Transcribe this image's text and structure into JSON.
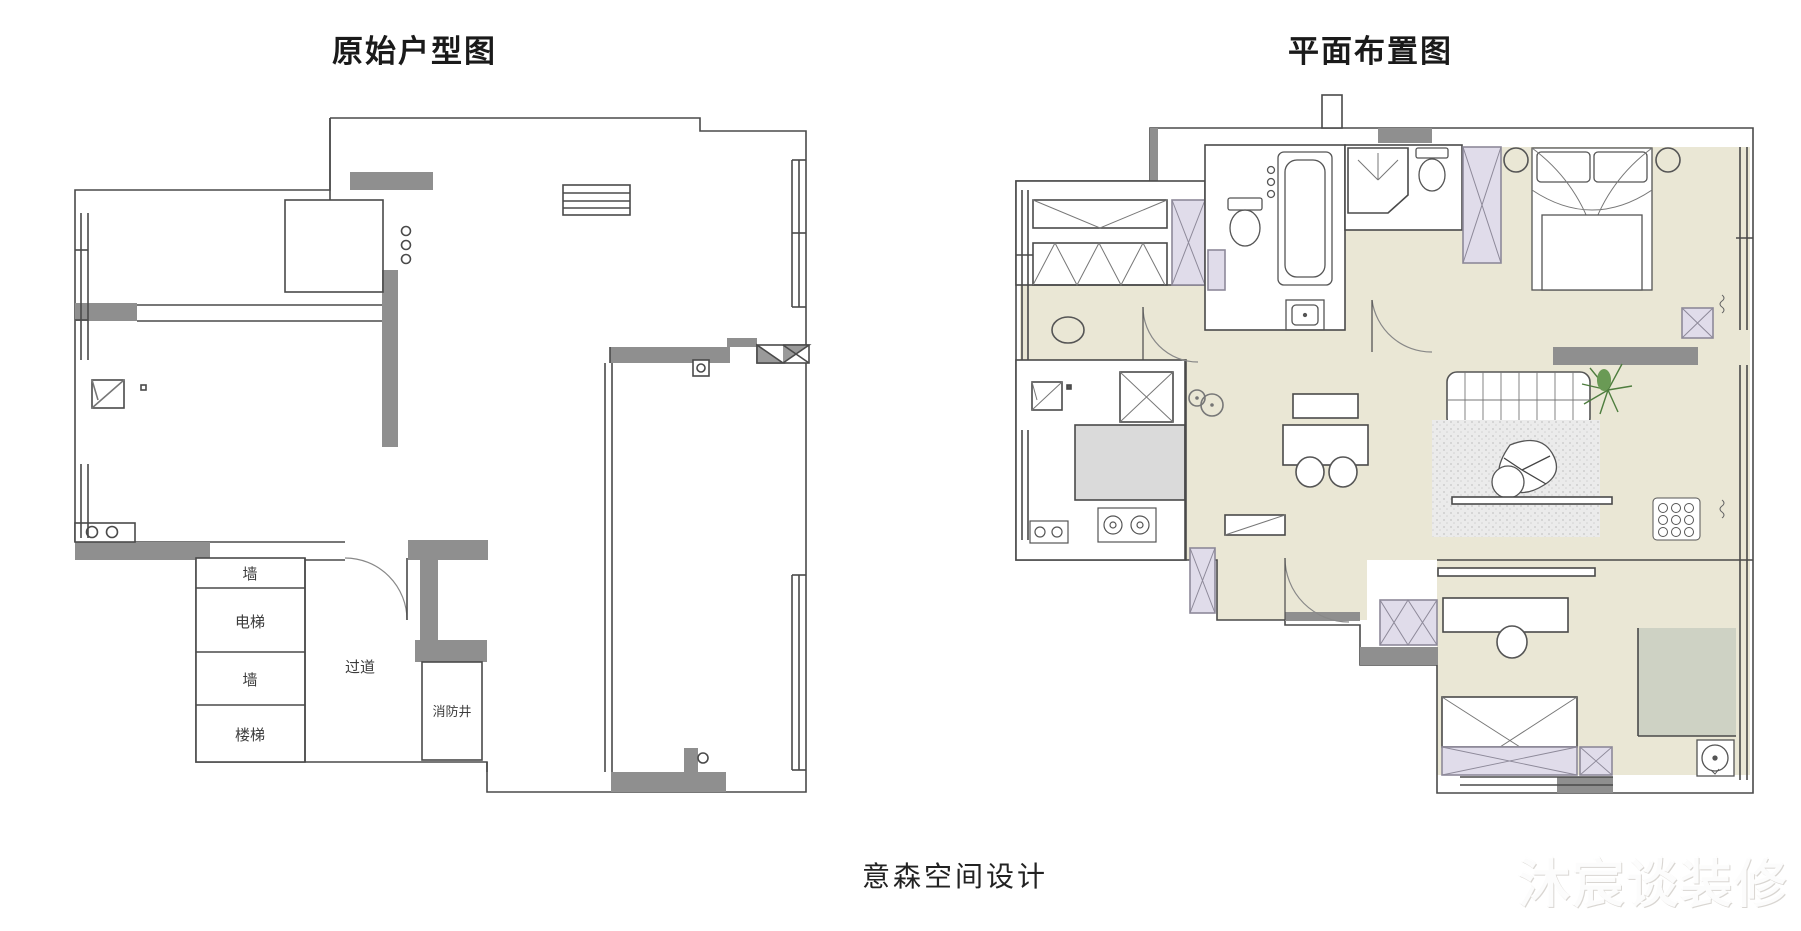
{
  "left_plan": {
    "title": "原始户型图",
    "labels": {
      "wall_top": "墙",
      "elevator": "电梯",
      "wall_bottom": "墙",
      "stairs": "楼梯",
      "corridor": "过道",
      "fire_shaft": "消防井"
    }
  },
  "right_plan": {
    "title": "平面布置图"
  },
  "footer": {
    "studio": "意森空间设计"
  },
  "watermark": {
    "text": "沐宸谈装修"
  },
  "colors": {
    "wall_fill": "#8f8f8f",
    "outline": "#4a4a4a",
    "floor_cream": "#eae7d5",
    "furniture_lavender": "#e0dcea",
    "counter_gray": "#dadada",
    "balcony_green": "#ced2c4",
    "rug_gray": "#ebebeb",
    "plant_green": "#4e7d3e",
    "background": "#ffffff"
  }
}
